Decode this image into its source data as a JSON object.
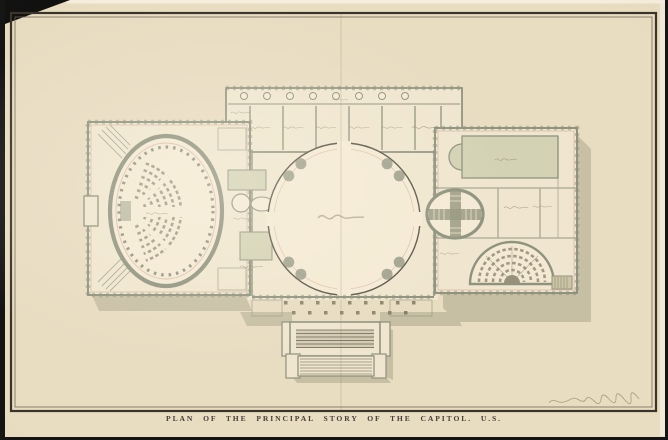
{
  "artwork": {
    "caption": "PLAN OF THE PRINCIPAL STORY OF THE CAPITOL. U.S."
  },
  "palette": {
    "background": "#141414",
    "paper": "#e8dcc1",
    "floor": "#f0e6cf",
    "floor2": "#f4ead4",
    "wall": "#8f937e",
    "wash_room": "#d3d2b4",
    "pink": "#c99e8d",
    "shadow": "#b2ac92",
    "ink": "#5c564a",
    "frame": "#3a342a",
    "caption_ink": "#45403a",
    "squiggle": "#86795f"
  }
}
